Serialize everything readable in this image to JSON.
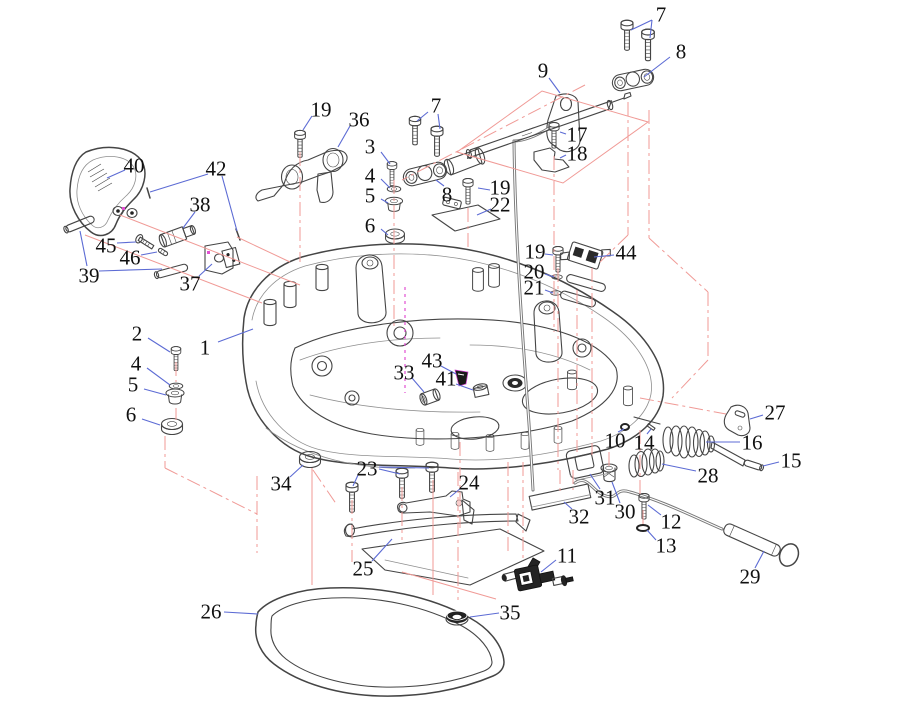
{
  "diagram": {
    "kind": "exploded-parts-diagram",
    "subject": "Outboard motor bottom cowling assembly — exploded parts view",
    "canvas": {
      "width": 912,
      "height": 720
    },
    "part_count": 46,
    "colors": {
      "background": "#ffffff",
      "line_art": "#454545",
      "leader_line": "#5c6bd4",
      "guide_line": "#f09a96",
      "center_line": "#e14fd2",
      "label_text": "#101010"
    },
    "label_font_size": 21,
    "callouts": [
      {
        "n": "1",
        "x": 205,
        "y": 347,
        "leaders": [
          [
            218,
            342,
            253,
            329
          ]
        ]
      },
      {
        "n": "2",
        "x": 137,
        "y": 333,
        "leaders": [
          [
            148,
            338,
            170,
            352
          ]
        ]
      },
      {
        "n": "3",
        "x": 370,
        "y": 146,
        "leaders": [
          [
            381,
            152,
            390,
            164
          ]
        ]
      },
      {
        "n": "4",
        "x": 370,
        "y": 175,
        "leaders": [
          [
            381,
            179,
            390,
            188
          ]
        ]
      },
      {
        "n": "5",
        "x": 370,
        "y": 195,
        "leaders": [
          [
            381,
            199,
            388,
            203
          ]
        ]
      },
      {
        "n": "6",
        "x": 370,
        "y": 225,
        "leaders": [
          [
            381,
            229,
            388,
            235
          ]
        ]
      },
      {
        "n": "7",
        "x": 661,
        "y": 14,
        "leaders": [
          [
            652,
            20,
            631,
            30
          ],
          [
            652,
            20,
            650,
            38
          ]
        ]
      },
      {
        "n": "8",
        "x": 681,
        "y": 51,
        "leaders": [
          [
            670,
            57,
            644,
            77
          ]
        ]
      },
      {
        "n": "9",
        "x": 543,
        "y": 70,
        "leaders": [
          [
            549,
            78,
            560,
            93
          ]
        ]
      },
      {
        "n": "7",
        "x": 436,
        "y": 105,
        "leaders": [
          [
            428,
            112,
            417,
            121
          ],
          [
            438,
            114,
            440,
            129
          ]
        ]
      },
      {
        "n": "8",
        "x": 447,
        "y": 194,
        "leaders": [
          [
            444,
            186,
            436,
            180
          ]
        ]
      },
      {
        "n": "17",
        "x": 577,
        "y": 134,
        "leaders": [
          [
            566,
            134,
            560,
            132
          ]
        ]
      },
      {
        "n": "18",
        "x": 577,
        "y": 153,
        "leaders": [
          [
            566,
            155,
            560,
            158
          ]
        ]
      },
      {
        "n": "19",
        "x": 321,
        "y": 109,
        "leaders": [
          [
            312,
            116,
            303,
            130
          ]
        ]
      },
      {
        "n": "36",
        "x": 359,
        "y": 119,
        "leaders": [
          [
            350,
            126,
            338,
            147
          ]
        ]
      },
      {
        "n": "19",
        "x": 500,
        "y": 187,
        "leaders": [
          [
            490,
            190,
            478,
            188
          ]
        ]
      },
      {
        "n": "22",
        "x": 500,
        "y": 204,
        "leaders": [
          [
            491,
            209,
            477,
            215
          ]
        ]
      },
      {
        "n": "19",
        "x": 535,
        "y": 251,
        "leaders": [
          [
            545,
            254,
            553,
            255
          ]
        ]
      },
      {
        "n": "20",
        "x": 534,
        "y": 271,
        "leaders": [
          [
            545,
            274,
            554,
            277
          ]
        ]
      },
      {
        "n": "21",
        "x": 534,
        "y": 287,
        "leaders": [
          [
            545,
            290,
            553,
            293
          ]
        ]
      },
      {
        "n": "44",
        "x": 626,
        "y": 252,
        "leaders": [
          [
            614,
            255,
            594,
            257
          ]
        ]
      },
      {
        "n": "40",
        "x": 134,
        "y": 165,
        "leaders": [
          [
            125,
            170,
            107,
            178
          ]
        ]
      },
      {
        "n": "42",
        "x": 216,
        "y": 168,
        "leaders": [
          [
            208,
            174,
            150,
            192
          ],
          [
            222,
            176,
            237,
            231
          ]
        ]
      },
      {
        "n": "38",
        "x": 200,
        "y": 204,
        "leaders": [
          [
            195,
            212,
            183,
            228
          ]
        ]
      },
      {
        "n": "45",
        "x": 106,
        "y": 245,
        "leaders": [
          [
            117,
            243,
            136,
            242
          ]
        ]
      },
      {
        "n": "46",
        "x": 130,
        "y": 257,
        "leaders": [
          [
            141,
            255,
            157,
            252
          ]
        ]
      },
      {
        "n": "39",
        "x": 89,
        "y": 275,
        "leaders": [
          [
            87,
            266,
            80,
            231
          ],
          [
            99,
            271,
            162,
            269
          ]
        ]
      },
      {
        "n": "37",
        "x": 190,
        "y": 283,
        "leaders": [
          [
            199,
            276,
            212,
            264
          ]
        ]
      },
      {
        "n": "4",
        "x": 136,
        "y": 363,
        "leaders": [
          [
            147,
            368,
            170,
            385
          ]
        ]
      },
      {
        "n": "5",
        "x": 133,
        "y": 384,
        "leaders": [
          [
            144,
            389,
            166,
            395
          ]
        ]
      },
      {
        "n": "6",
        "x": 131,
        "y": 414,
        "leaders": [
          [
            142,
            419,
            160,
            425
          ]
        ]
      },
      {
        "n": "33",
        "x": 404,
        "y": 372,
        "leaders": [
          [
            412,
            378,
            424,
            392
          ]
        ]
      },
      {
        "n": "43",
        "x": 432,
        "y": 360,
        "leaders": [
          [
            441,
            366,
            456,
            374
          ]
        ]
      },
      {
        "n": "41",
        "x": 446,
        "y": 378,
        "leaders": [
          [
            456,
            384,
            473,
            390
          ]
        ]
      },
      {
        "n": "10",
        "x": 615,
        "y": 440,
        "leaders": [
          [
            618,
            432,
            624,
            429
          ]
        ]
      },
      {
        "n": "14",
        "x": 644,
        "y": 442,
        "leaders": [
          [
            647,
            434,
            651,
            429
          ]
        ]
      },
      {
        "n": "27",
        "x": 775,
        "y": 412,
        "leaders": [
          [
            763,
            415,
            750,
            419
          ]
        ]
      },
      {
        "n": "16",
        "x": 752,
        "y": 442,
        "leaders": [
          [
            740,
            442,
            706,
            442
          ]
        ]
      },
      {
        "n": "15",
        "x": 791,
        "y": 460,
        "leaders": [
          [
            779,
            462,
            763,
            466
          ]
        ]
      },
      {
        "n": "28",
        "x": 708,
        "y": 475,
        "leaders": [
          [
            696,
            471,
            662,
            464
          ]
        ]
      },
      {
        "n": "24",
        "x": 469,
        "y": 482,
        "leaders": [
          [
            461,
            488,
            450,
            497
          ]
        ]
      },
      {
        "n": "31",
        "x": 605,
        "y": 497,
        "leaders": [
          [
            600,
            489,
            590,
            474
          ]
        ]
      },
      {
        "n": "30",
        "x": 625,
        "y": 511,
        "leaders": [
          [
            620,
            503,
            612,
            482
          ]
        ]
      },
      {
        "n": "32",
        "x": 579,
        "y": 516,
        "leaders": [
          [
            572,
            509,
            564,
            502
          ]
        ]
      },
      {
        "n": "12",
        "x": 671,
        "y": 521,
        "leaders": [
          [
            661,
            515,
            648,
            505
          ]
        ]
      },
      {
        "n": "13",
        "x": 666,
        "y": 545,
        "leaders": [
          [
            656,
            540,
            647,
            530
          ]
        ]
      },
      {
        "n": "34",
        "x": 281,
        "y": 483,
        "leaders": [
          [
            290,
            477,
            303,
            465
          ]
        ]
      },
      {
        "n": "23",
        "x": 367,
        "y": 468,
        "leaders": [
          [
            358,
            475,
            353,
            486
          ],
          [
            379,
            469,
            400,
            474
          ],
          [
            379,
            467,
            429,
            468
          ]
        ]
      },
      {
        "n": "25",
        "x": 363,
        "y": 568,
        "leaders": [
          [
            372,
            561,
            392,
            539
          ]
        ]
      },
      {
        "n": "11",
        "x": 567,
        "y": 555,
        "leaders": [
          [
            556,
            560,
            541,
            572
          ]
        ]
      },
      {
        "n": "29",
        "x": 750,
        "y": 576,
        "leaders": [
          [
            755,
            568,
            764,
            551
          ]
        ]
      },
      {
        "n": "35",
        "x": 510,
        "y": 612,
        "leaders": [
          [
            499,
            613,
            470,
            617
          ]
        ]
      },
      {
        "n": "26",
        "x": 211,
        "y": 611,
        "leaders": [
          [
            224,
            612,
            258,
            614
          ]
        ]
      }
    ]
  }
}
